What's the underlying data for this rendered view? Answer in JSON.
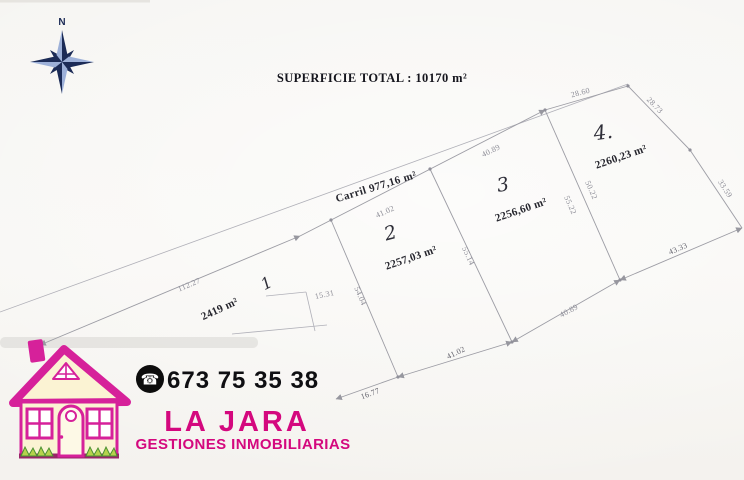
{
  "title": "SUPERFICIE TOTAL : 10170 m²",
  "compass": {
    "north_label": "N",
    "color_dark": "#1c2b56",
    "color_light": "#9db0d8"
  },
  "plan": {
    "road_label": "Carril  977,16 m²",
    "plots": [
      {
        "number": "1",
        "area": "2419 m²"
      },
      {
        "number": "2",
        "area": "2257,03 m²"
      },
      {
        "number": "3",
        "area": "2256,60 m²"
      },
      {
        "number": "4.",
        "area": "2260,23 m²"
      }
    ],
    "dims": {
      "road_left": "112.27",
      "plot2_top": "41.02",
      "plot3_top": "40.89",
      "plot4_top_left": "28.60",
      "plot4_top_right": "28.73",
      "plot4_right": "33.59",
      "plot4_bottom": "43.33",
      "plot3_bottom": "40.89",
      "plot2_bottom": "41.02",
      "bottom_left_end": "16.77",
      "plot1_right": "15.31",
      "divider_1_2": "54.04",
      "divider_2_3": "55.14",
      "divider_3_4_left": "55.22",
      "divider_3_4_right": "50.22"
    }
  },
  "logo": {
    "phone": "673 75 35 38",
    "brand": "LA JARA",
    "tagline": "GESTIONES INMOBILIARIAS",
    "brand_color": "#d4087e"
  }
}
